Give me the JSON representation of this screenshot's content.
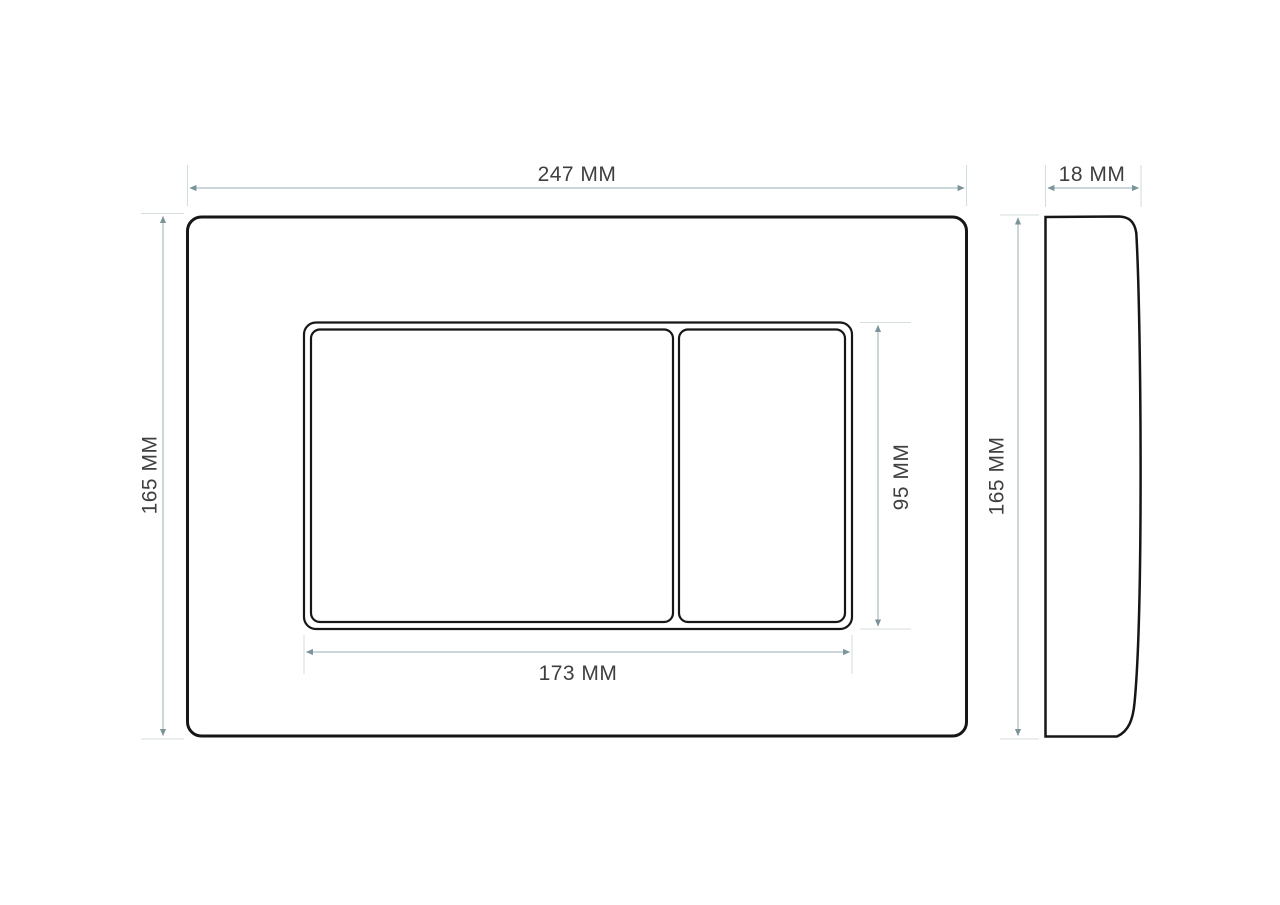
{
  "drawing": {
    "type": "technical-dimension-drawing",
    "subject": "toilet flush plate with two buttons, front view and side profile view",
    "front_view": {
      "overall_width_label": "247 MM",
      "overall_height_label": "165 MM",
      "button_panel_width_label": "173 MM",
      "button_panel_height_label": "95 MM"
    },
    "side_view": {
      "depth_label": "18 MM",
      "overall_height_label": "165 MM"
    },
    "colors": {
      "background": "#ffffff",
      "outline": "#161616",
      "dimension_line": "#aebfc2",
      "extension_line": "#d5dedf",
      "arrowhead": "#7b949a",
      "label_text": "#3f3f3f"
    }
  }
}
